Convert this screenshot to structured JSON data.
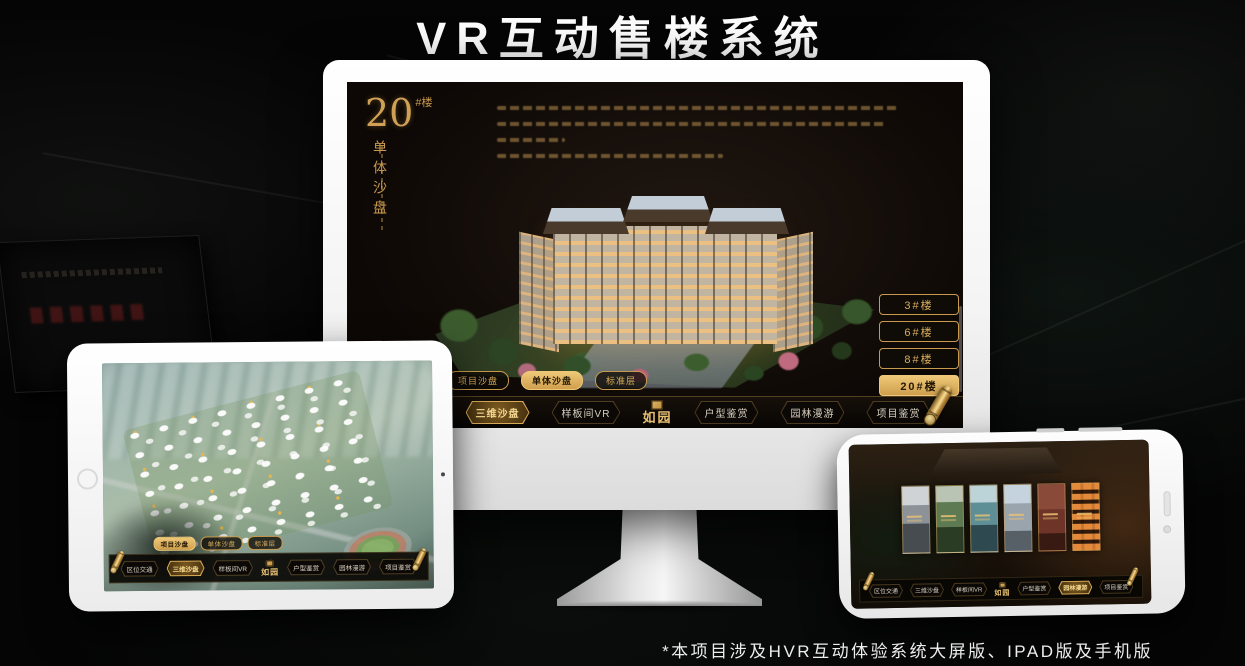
{
  "page": {
    "title": "VR互动售楼系统",
    "footnote": "*本项目涉及HVR互动体验系统大屏版、IPAD版及手机版"
  },
  "colors": {
    "gold": "#c99a4e",
    "gold_bright": "#e8c172",
    "screen_bg": "#0d0805",
    "text_light": "#ededed"
  },
  "monitor": {
    "block": {
      "number": "20",
      "unit": "#楼",
      "subtitle": "单体沙盘"
    },
    "building_buttons": [
      "3#楼",
      "6#楼",
      "8#楼",
      "20#楼"
    ],
    "active_building": "20#楼",
    "tabs": [
      "项目沙盘",
      "单体沙盘",
      "标准层"
    ],
    "active_tab": "单体沙盘",
    "nav": [
      "区位交通",
      "三维沙盘",
      "样板间VR",
      "户型鉴赏",
      "园林漫游",
      "项目鉴赏"
    ],
    "active_nav": "三维沙盘",
    "logo": "如园"
  },
  "tablet": {
    "tabs": [
      "项目沙盘",
      "单体沙盘",
      "标准层"
    ],
    "active_tab": "项目沙盘",
    "nav": [
      "区位交通",
      "三维沙盘",
      "样板间VR",
      "户型鉴赏",
      "园林漫游",
      "项目鉴赏"
    ],
    "active_nav": "三维沙盘",
    "logo": "如园"
  },
  "phone": {
    "nav": [
      "区位交通",
      "三维沙盘",
      "样板间VR",
      "户型鉴赏",
      "园林漫游",
      "项目鉴赏"
    ],
    "active_nav": "园林漫游",
    "logo": "如园"
  }
}
